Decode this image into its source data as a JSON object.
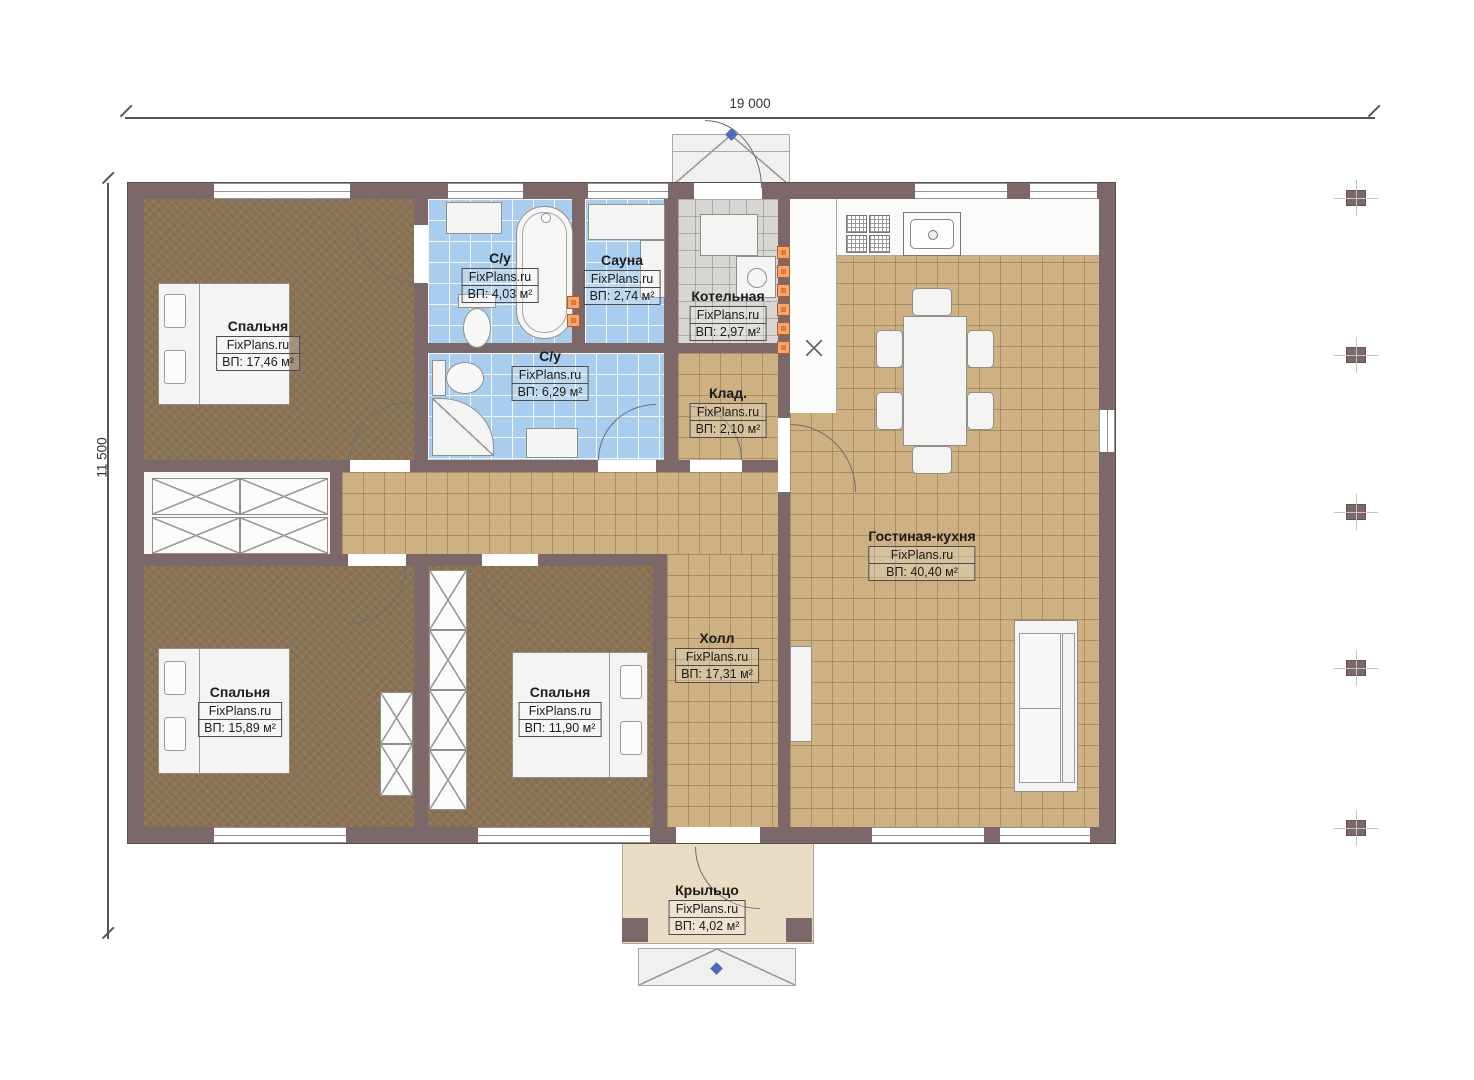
{
  "dimensions": {
    "width_label": "19 000",
    "height_label": "11 500"
  },
  "rooms": [
    {
      "id": "bedroom-1",
      "name": "Спальня",
      "brand": "FixPlans.ru",
      "area": "ВП: 17,46 м²"
    },
    {
      "id": "bathroom-1",
      "name": "С/у",
      "brand": "FixPlans.ru",
      "area": "ВП: 4,03 м²"
    },
    {
      "id": "sauna",
      "name": "Сауна",
      "brand": "FixPlans.ru",
      "area": "ВП: 2,74 м²"
    },
    {
      "id": "boiler",
      "name": "Котельная",
      "brand": "FixPlans.ru",
      "area": "ВП: 2,97 м²"
    },
    {
      "id": "bathroom-2",
      "name": "С/у",
      "brand": "FixPlans.ru",
      "area": "ВП: 6,29 м²"
    },
    {
      "id": "storage",
      "name": "Клад.",
      "brand": "FixPlans.ru",
      "area": "ВП: 2,10 м²"
    },
    {
      "id": "living",
      "name": "Гостиная-кухня",
      "brand": "FixPlans.ru",
      "area": "ВП: 40,40 м²"
    },
    {
      "id": "hall",
      "name": "Холл",
      "brand": "FixPlans.ru",
      "area": "ВП: 17,31 м²"
    },
    {
      "id": "bedroom-2",
      "name": "Спальня",
      "brand": "FixPlans.ru",
      "area": "ВП: 15,89 м²"
    },
    {
      "id": "bedroom-3",
      "name": "Спальня",
      "brand": "FixPlans.ru",
      "area": "ВП: 11,90 м²"
    },
    {
      "id": "porch",
      "name": "Крыльцо",
      "brand": "FixPlans.ru",
      "area": "ВП: 4,02 м²"
    }
  ],
  "colors": {
    "wall": "#7c6868",
    "wood_floor": "#8b7355",
    "tile_blue": "#a9cdee",
    "tile_tan": "#cdb183",
    "tile_grey": "#d8d6d3",
    "porch": "#e9dcc4",
    "radiator_orange": "#e8792b",
    "marker_blue": "#4a6cc0"
  }
}
